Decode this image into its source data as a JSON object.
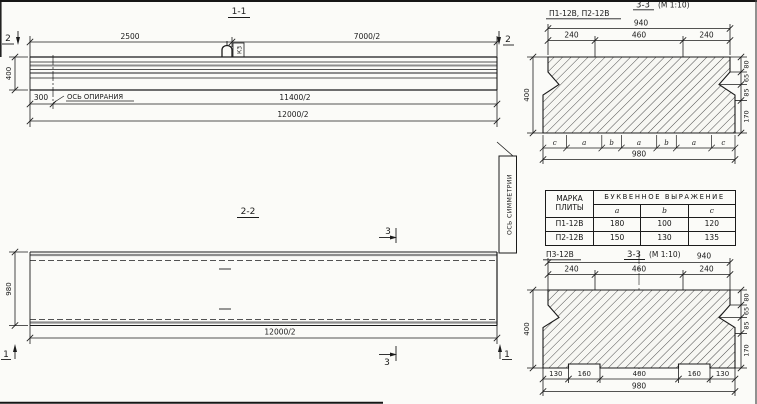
{
  "sec11": {
    "title": "1-1",
    "dim_2500": "2500",
    "dim_7000": "7000/2",
    "dim_300": "300",
    "dim_11400": "11400/2",
    "dim_12000": "12000/2",
    "dim_400": "400",
    "bearing_label": "ОСЬ ОПИРАНИЯ",
    "loop_mark": "К3",
    "cut2": "2"
  },
  "sec22": {
    "title": "2-2",
    "dim_980": "980",
    "dim_12000": "12000/2",
    "sym_label": "ОСЬ СИММЕТРИИ",
    "cut3": "3",
    "cut1": "1"
  },
  "p12": {
    "label": "П1-12В, П2-12В",
    "title": "3-3",
    "scale": "(М 1:10)",
    "dim_940": "940",
    "dim_240": "240",
    "dim_460": "460",
    "dim_400": "400",
    "dim_80": "80",
    "dim_65": "65",
    "dim_85": "85",
    "dim_170": "170",
    "dim_980": "980",
    "letters": [
      "c",
      "a",
      "b",
      "a",
      "b",
      "a",
      "c"
    ]
  },
  "table": {
    "h_mark1": "МАРКА",
    "h_mark2": "ПЛИТЫ",
    "h_expr": "БУКВЕННОЕ ВЫРАЖЕНИЕ",
    "col_a": "a",
    "col_b": "b",
    "col_c": "c",
    "rows": [
      {
        "mark": "П1-12В",
        "a": "180",
        "b": "100",
        "c": "120"
      },
      {
        "mark": "П2-12В",
        "a": "150",
        "b": "130",
        "c": "135"
      }
    ]
  },
  "p3": {
    "label": "П3-12В",
    "title": "3-3",
    "scale": "(М 1:10)",
    "dim_940": "940",
    "dim_240": "240",
    "dim_460": "460",
    "dim_400": "400",
    "dim_80": "80",
    "dim_65": "65",
    "dim_85": "85",
    "dim_170": "170",
    "dim_130": "130",
    "dim_160": "160",
    "dim_400b": "400",
    "dim_980": "980"
  }
}
